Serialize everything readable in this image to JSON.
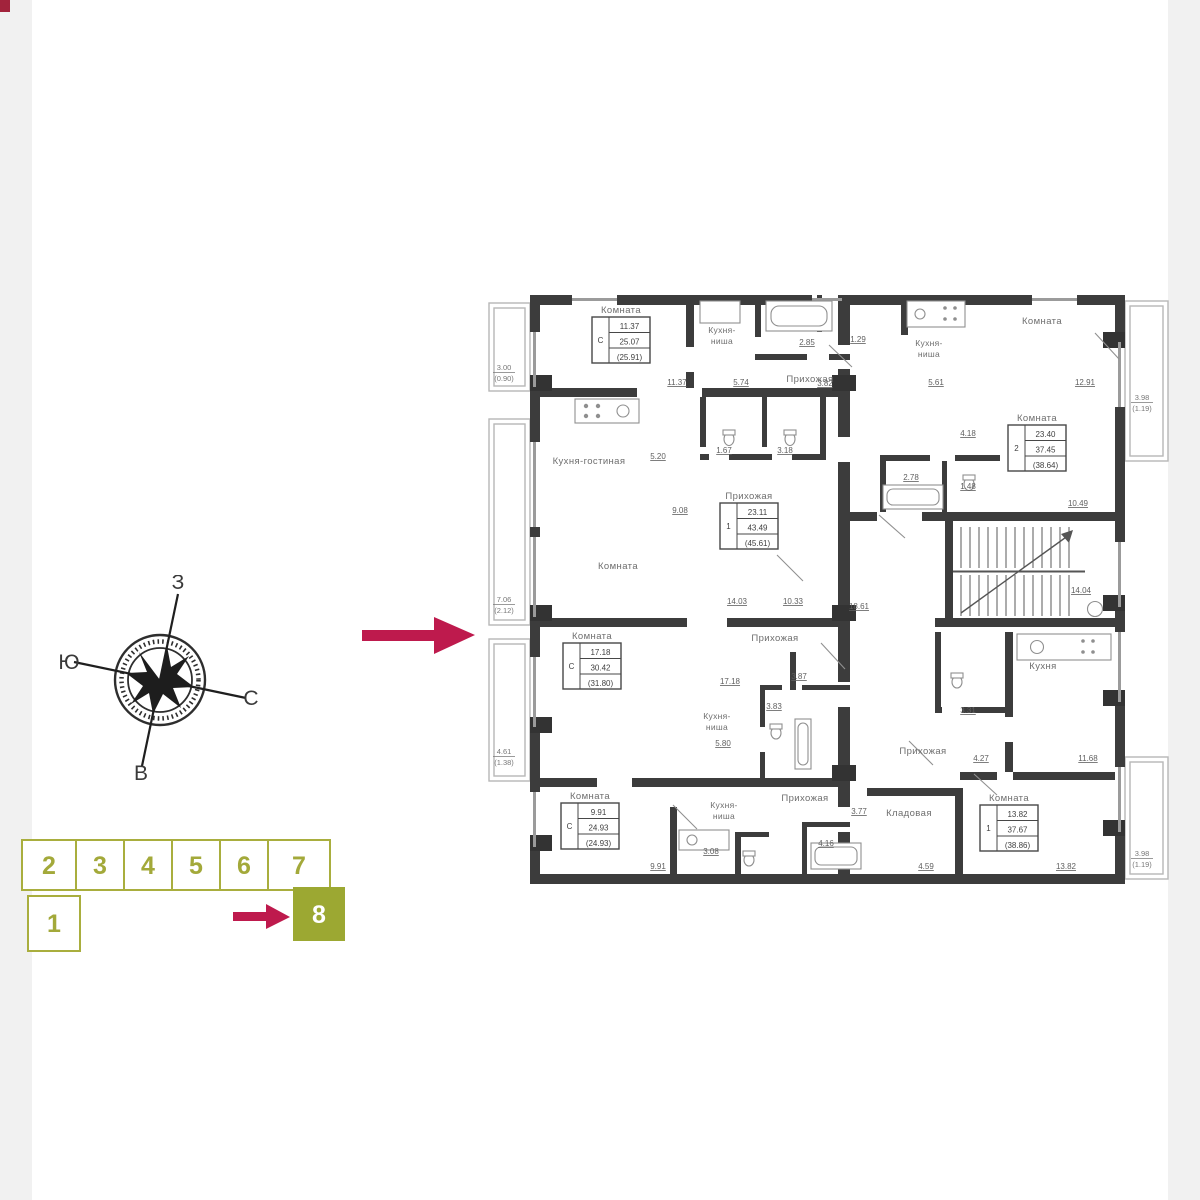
{
  "canvas": {
    "bg": "#ffffff",
    "side_strip": "#f1f1f1",
    "corner_mark_color": "#a2233c"
  },
  "compass": {
    "top": "З",
    "left": "Ю",
    "right": "С",
    "bottom": "В"
  },
  "pointer": {
    "color": "#be1a4d"
  },
  "site_plan": {
    "sections": [
      "1",
      "2",
      "3",
      "4",
      "5",
      "6",
      "7",
      "8"
    ],
    "active_section": "8",
    "outline_color": "#a9ae3e",
    "active_fill": "#9ca832",
    "arrow_color": "#be1a4d"
  },
  "floorplan": {
    "wall_color": "#3c3c3c",
    "units": [
      {
        "key": "studio-top-left",
        "labels": {
          "room": "Комната",
          "kitchen_line1": "Кухня-",
          "kitchen_line2": "ниша",
          "hall": "Прихожая"
        },
        "stamp": {
          "rooms": "С",
          "living": "11.37",
          "area": "25.07",
          "total": "(25.91)"
        },
        "dims": {
          "room_width": "11.37",
          "kitchen_width": "5.74",
          "hall": "3.82",
          "bath": "2.85",
          "wc": "1.29"
        },
        "balcony": {
          "area": "3.00",
          "reduced": "(0.90)"
        }
      },
      {
        "key": "two-room-top-right",
        "labels": {
          "room": "Комната",
          "kitchen_line1": "Кухня-",
          "kitchen_line2": "ниша"
        },
        "stamp": {
          "rooms": "2",
          "living": "23.40",
          "area": "37.45",
          "total": "(38.64)"
        },
        "dims": {
          "room_width": "12.91",
          "kitchen_width": "5.61",
          "hall": "4.18",
          "bath": "2.78",
          "wc": "1.48",
          "inner_width": "10.49"
        },
        "balcony": {
          "area": "3.98",
          "reduced": "(1.19)"
        }
      },
      {
        "key": "one-room-middle-left",
        "labels": {
          "kitchen_living": "Кухня-гостиная",
          "room": "Комната",
          "hall": "Прихожая"
        },
        "stamp": {
          "rooms": "1",
          "living": "23.11",
          "area": "43.49",
          "total": "(45.61)"
        },
        "dims": {
          "kitchen": "5.20",
          "bath": "1.67",
          "wc": "3.18",
          "hall_width": "9.08",
          "room_width_1": "14.03",
          "room_width_2": "10.33"
        },
        "balcony": {
          "area": "7.06",
          "reduced": "(2.12)"
        }
      },
      {
        "key": "studio-middle-left",
        "labels": {
          "room": "Комната",
          "hall": "Прихожая",
          "kitchen_line1": "Кухня-",
          "kitchen_line2": "ниша"
        },
        "stamp": {
          "rooms": "С",
          "living": "17.18",
          "area": "30.42",
          "total": "(31.80)"
        },
        "dims": {
          "hall_width": "17.18",
          "bath": "3.87",
          "wc": "3.83",
          "kitchen": "5.80"
        },
        "balcony": {
          "area": "4.61",
          "reduced": "(1.38)"
        }
      },
      {
        "key": "studio-bottom-left",
        "labels": {
          "room": "Комната",
          "kitchen_line1": "Кухня-",
          "kitchen_line2": "ниша",
          "hall": "Прихожая"
        },
        "stamp": {
          "rooms": "С",
          "living": "9.91",
          "area": "24.93",
          "total": "(24.93)"
        },
        "dims": {
          "room_width": "9.91",
          "kitchen": "3.08",
          "bath": "4.16",
          "hall": "3.77"
        }
      },
      {
        "key": "one-room-bottom-right",
        "labels": {
          "kitchen": "Кухня",
          "room": "Комната",
          "hall": "Прихожая",
          "storage": "Кладовая"
        },
        "stamp": {
          "rooms": "1",
          "living": "13.82",
          "area": "37.67",
          "total": "(38.86)"
        },
        "dims": {
          "kitchen_width": "11.68",
          "room_width": "13.82",
          "hall": "4.27",
          "storage": "4.59",
          "bath": "3.31"
        },
        "balcony": {
          "area": "3.98",
          "reduced": "(1.19)"
        }
      }
    ],
    "core": {
      "dims": {
        "corridor": "18.61",
        "stairs": "14.04"
      }
    }
  }
}
